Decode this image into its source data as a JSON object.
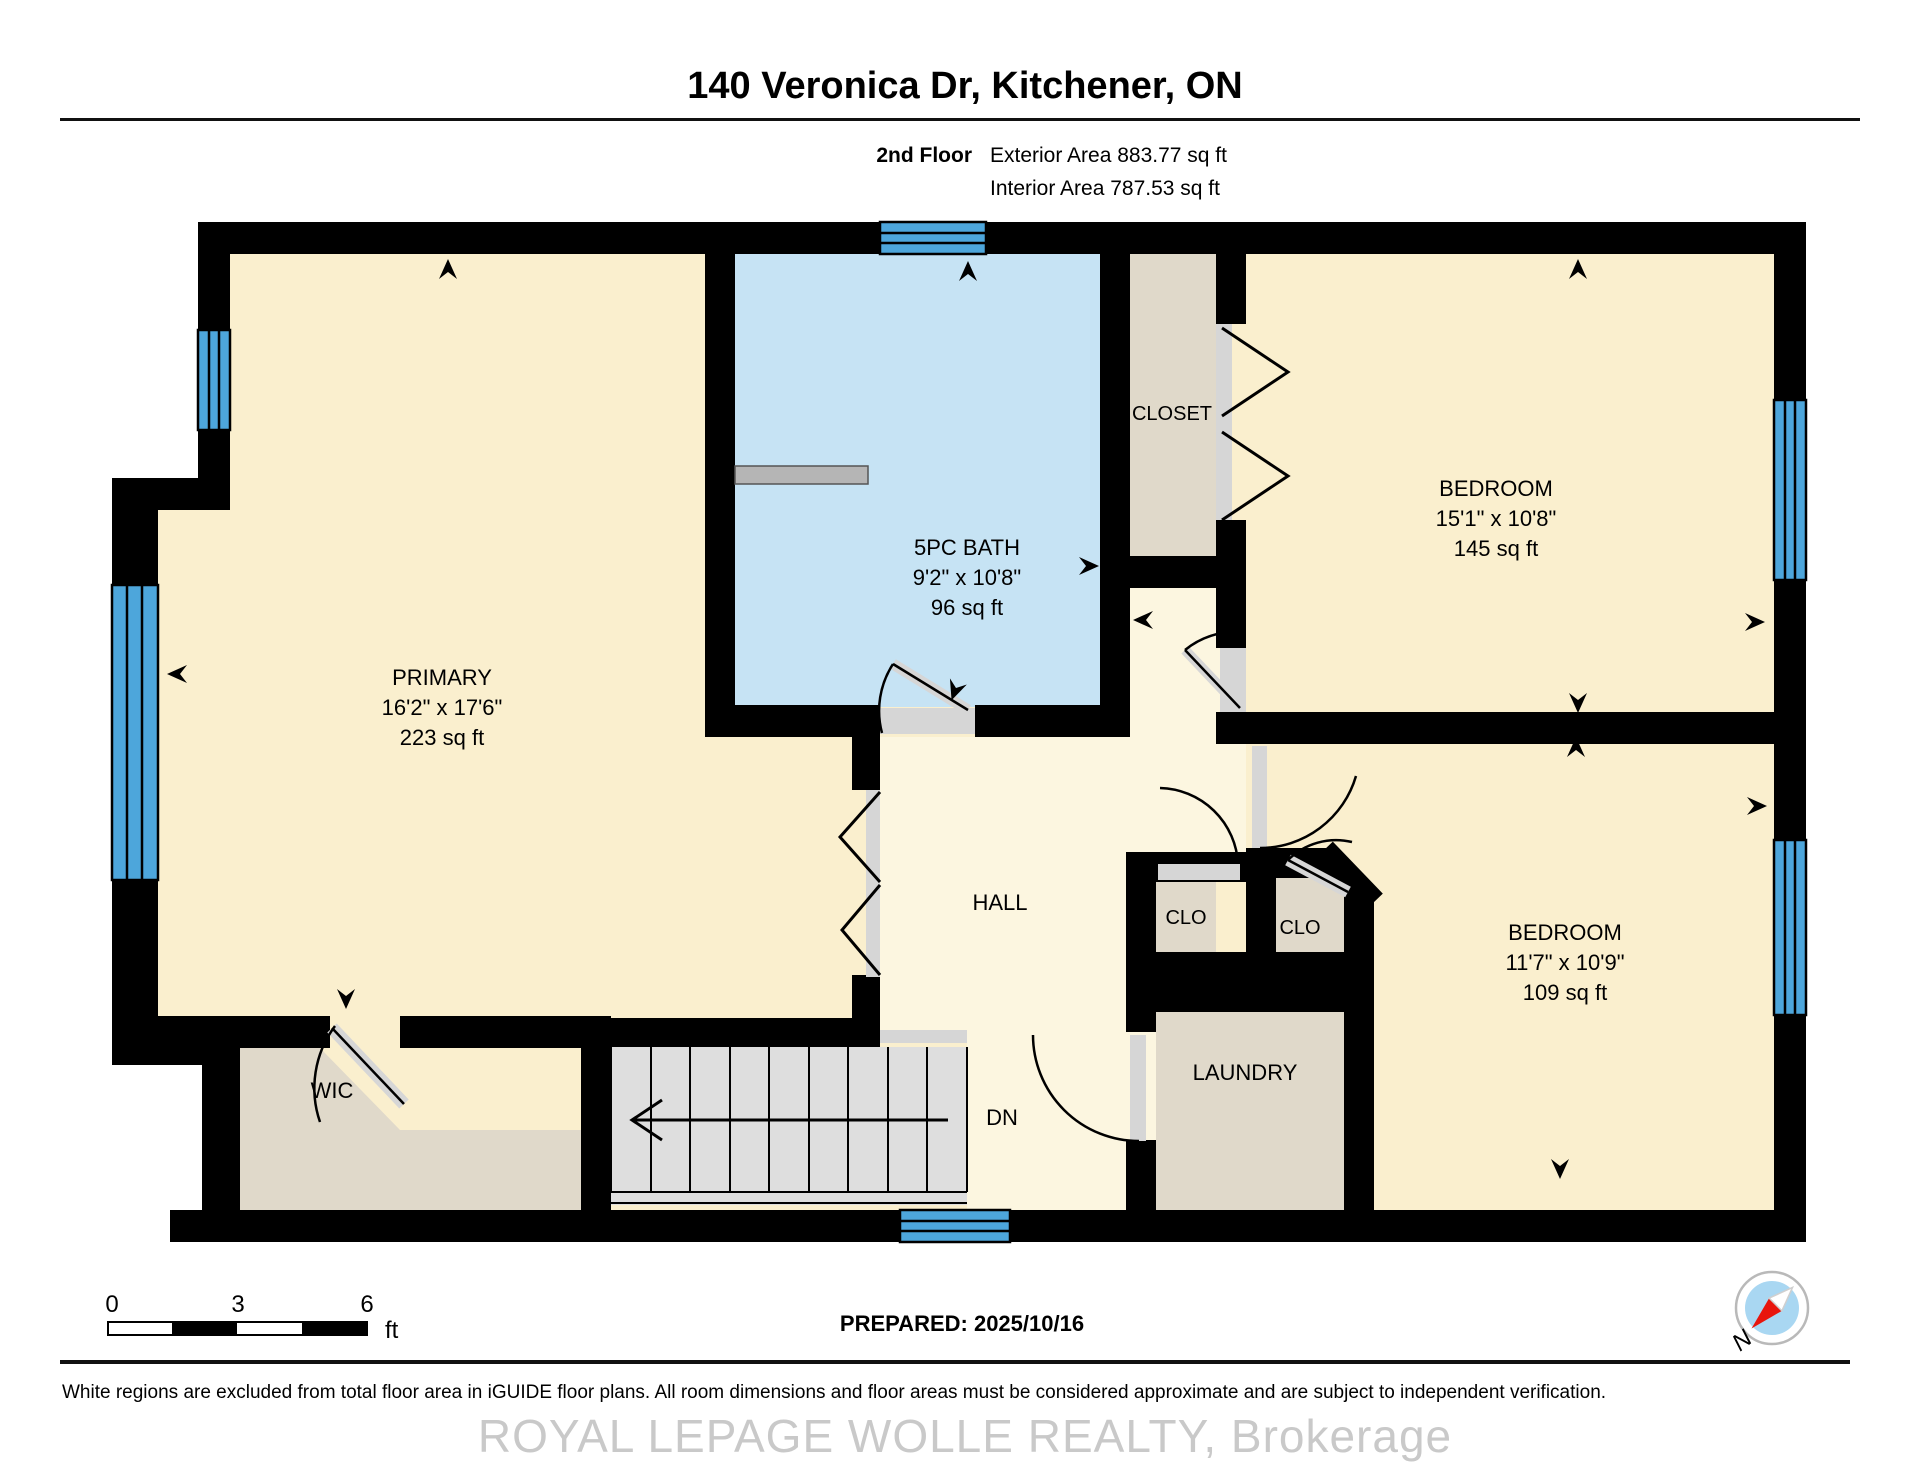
{
  "header": {
    "title": "140 Veronica Dr, Kitchener, ON",
    "floor_label": "2nd Floor",
    "exterior_area": "Exterior Area 883.77 sq ft",
    "interior_area": "Interior Area 787.53 sq ft"
  },
  "rooms": [
    {
      "name": "PRIMARY",
      "dimensions": "16'2\" x 17'6\"",
      "area": "223 sq ft"
    },
    {
      "name": "5PC BATH",
      "dimensions": "9'2\" x 10'8\"",
      "area": "96 sq ft"
    },
    {
      "name": "CLOSET"
    },
    {
      "name": "BEDROOM",
      "dimensions": "15'1\" x 10'8\"",
      "area": "145 sq ft"
    },
    {
      "name": "HALL"
    },
    {
      "name": "CLO"
    },
    {
      "name": "CLO"
    },
    {
      "name": "LAUNDRY"
    },
    {
      "name": "BEDROOM",
      "dimensions": "11'7\" x 10'9\"",
      "area": "109 sq ft"
    },
    {
      "name": "WIC"
    },
    {
      "name": "DN"
    }
  ],
  "scale_bar": {
    "ticks": [
      "0",
      "3",
      "6"
    ],
    "unit": "ft"
  },
  "footer": {
    "prepared": "PREPARED: 2025/10/16",
    "disclaimer": "White regions are excluded from total floor area in iGUIDE floor plans. All room dimensions and floor areas must be considered approximate and are subject to independent verification.",
    "watermark": "ROYAL LEPAGE WOLLE REALTY, Brokerage"
  },
  "compass": {
    "north_label": "N"
  },
  "colors": {
    "wall": "#000000",
    "room_cream": "#FAEFCE",
    "hall_cream": "#FCF6E0",
    "bath_blue": "#C6E3F4",
    "window_blue": "#4DA6DB",
    "closet_tan": "#E0D9CA",
    "stairs_gray": "#DEDEDE",
    "compass_blue": "#A9D7F2",
    "compass_needle_red": "#E8150D"
  }
}
